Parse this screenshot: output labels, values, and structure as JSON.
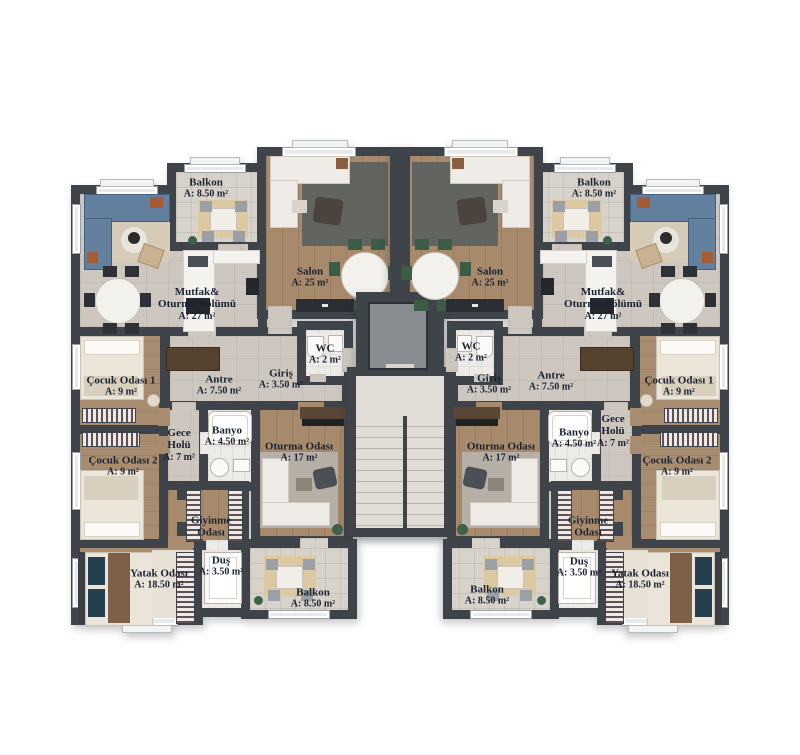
{
  "plan_type": "apartment-floor-plan",
  "rooms": {
    "balkon": {
      "name": "Balkon",
      "area": "A: 8.50 m²"
    },
    "mutfak": {
      "line1": "Mutfak&",
      "line2": "Oturma Bölümü",
      "area": "A: 27 m²"
    },
    "salon": {
      "name": "Salon",
      "area": "A: 25 m²"
    },
    "wc": {
      "name": "WC",
      "area": "A: 2 m²"
    },
    "giris": {
      "name": "Giriş",
      "area": "A: 3.50 m²"
    },
    "antre": {
      "name": "Antre",
      "area": "A: 7.50 m²"
    },
    "cocuk1": {
      "name": "Çocuk Odası 1",
      "area": "A: 9 m²"
    },
    "gece_holu": {
      "line1": "Gece",
      "line2": "Holü",
      "area": "A: 7 m²"
    },
    "banyo": {
      "name": "Banyo",
      "area": "A: 4.50 m²"
    },
    "oturma": {
      "name": "Oturma Odası",
      "area": "A: 17 m²"
    },
    "cocuk2": {
      "name": "Çocuk Odası 2",
      "area": "A: 9 m²"
    },
    "giyinme": {
      "line1": "Giyinme",
      "line2": "Odası"
    },
    "dus": {
      "name": "Duş",
      "area": "A: 3.50 m²"
    },
    "yatak": {
      "name": "Yatak Odası",
      "area": "A: 18.50 m²"
    },
    "balkon_alt": {
      "name": "Balkon",
      "area": "A: 8.50 m²"
    }
  },
  "colors": {
    "wall": "#3f444b",
    "wood_floor": "#a78a6c",
    "tile_floor": "#cdc7bf",
    "balcony_floor": "#d8d3ca",
    "bath_floor": "#edebe7",
    "stair_floor": "#e0dcd6",
    "label_text": "#1b2331",
    "sofa_blue": "#64809f",
    "sofa_white": "#efece7",
    "chair_green": "#3c5c46",
    "background": "#ffffff"
  }
}
